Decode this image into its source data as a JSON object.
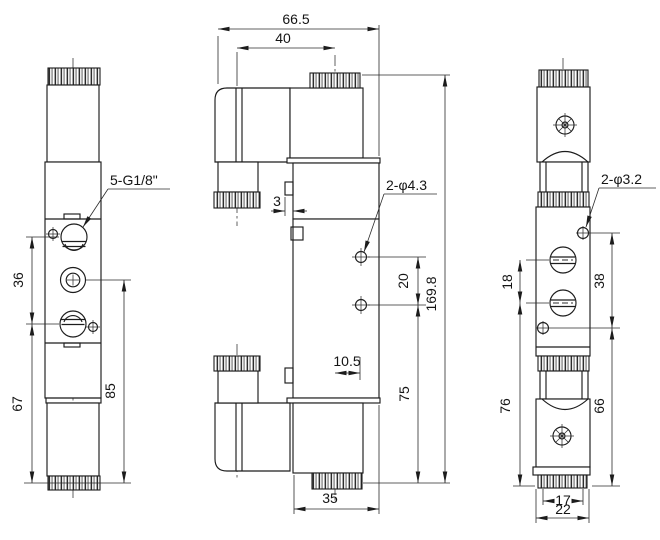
{
  "drawing": {
    "front_view": {
      "port_label": "5-G1/8\"",
      "dims": {
        "ports_span": "36",
        "port3_to_bottom": "67",
        "port2_to_bottom": "85"
      }
    },
    "side_view": {
      "hole_label": "2-φ4.3",
      "dims": {
        "overall_width": "66.5",
        "gland_to_center": "40",
        "tab_depth": "3",
        "hole_spacing": "20",
        "overall_height": "169.8",
        "hole_to_bottom": "75",
        "center_to_edge": "10.5",
        "body_width": "35"
      }
    },
    "end_view": {
      "hole_label": "2-φ3.2",
      "dims": {
        "port_spacing": "18",
        "hole_spacing": "38",
        "port_to_bottom": "76",
        "hole_to_bottom": "66",
        "base_width": "17",
        "overall_width": "22"
      }
    }
  }
}
